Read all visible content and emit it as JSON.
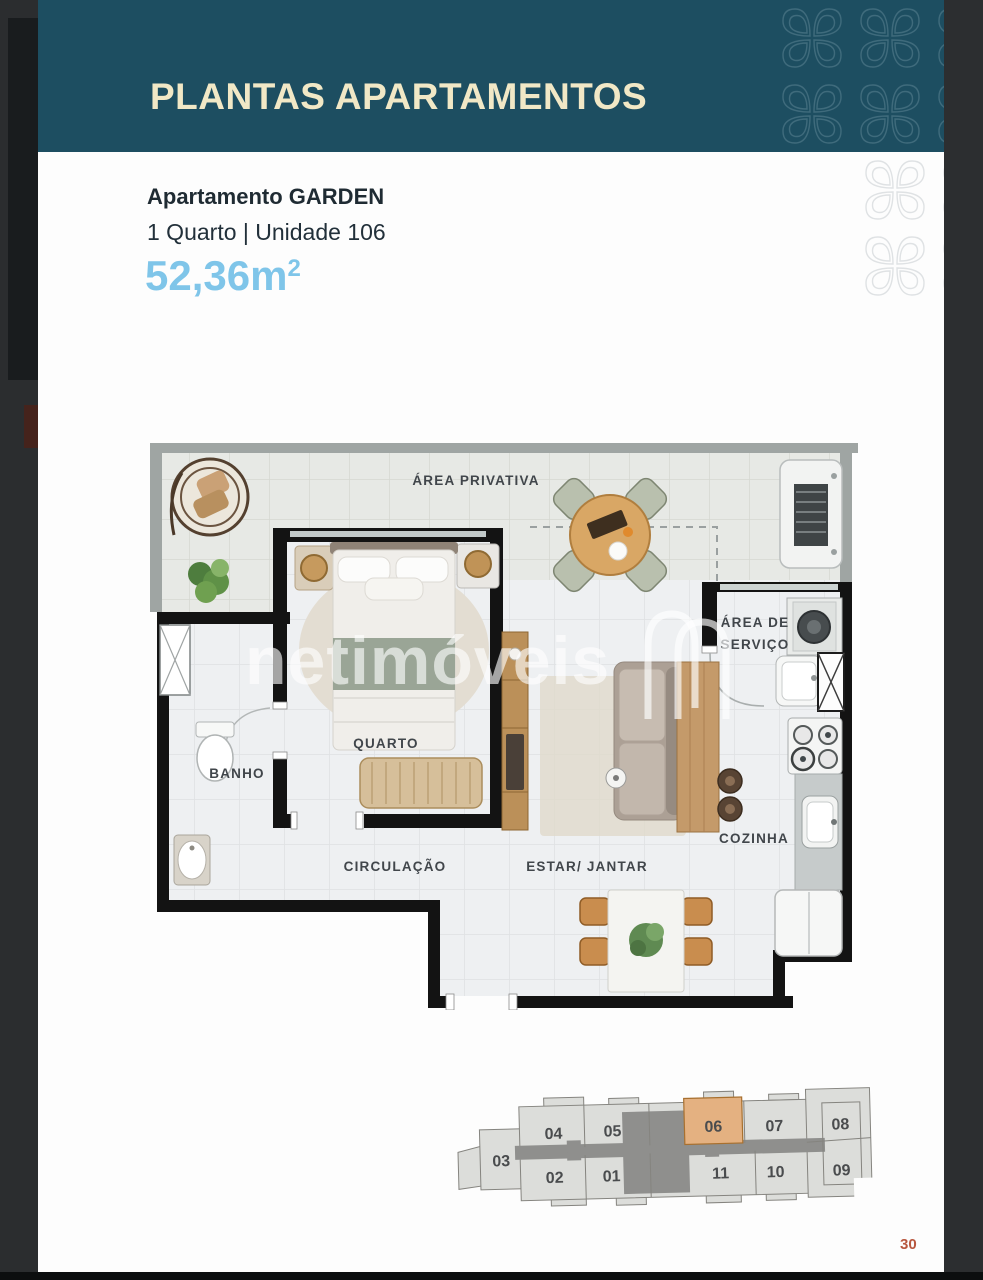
{
  "header": {
    "title": "PLANTAS APARTAMENTOS"
  },
  "apartment": {
    "name": "Apartamento GARDEN",
    "details": "1 Quarto | Unidade 106",
    "area": "52,36m",
    "area_exponent": "2"
  },
  "floorplan": {
    "watermark": "netimóveis",
    "labels": {
      "area_privativa": "ÁREA PRIVATIVA",
      "quarto": "QUARTO",
      "banho": "BANHO",
      "circulacao": "CIRCULAÇÃO",
      "estar_jantar": "ESTAR/ JANTAR",
      "cozinha": "COZINHA",
      "area_servico_line1": "ÁREA DE",
      "area_servico_line2": "SERVIÇO"
    }
  },
  "unit_key": {
    "highlighted_unit": "06",
    "units": [
      "04",
      "05",
      "06",
      "07",
      "08",
      "03",
      "02",
      "01",
      "11",
      "10",
      "09"
    ]
  },
  "page": {
    "number": "30"
  },
  "colors": {
    "header_teal": "#1d4e61",
    "title_cream": "#f1e8c6",
    "area_blue": "#7fc5e9",
    "highlight_orange": "#e4b181",
    "page_number_red": "#b8573f"
  }
}
